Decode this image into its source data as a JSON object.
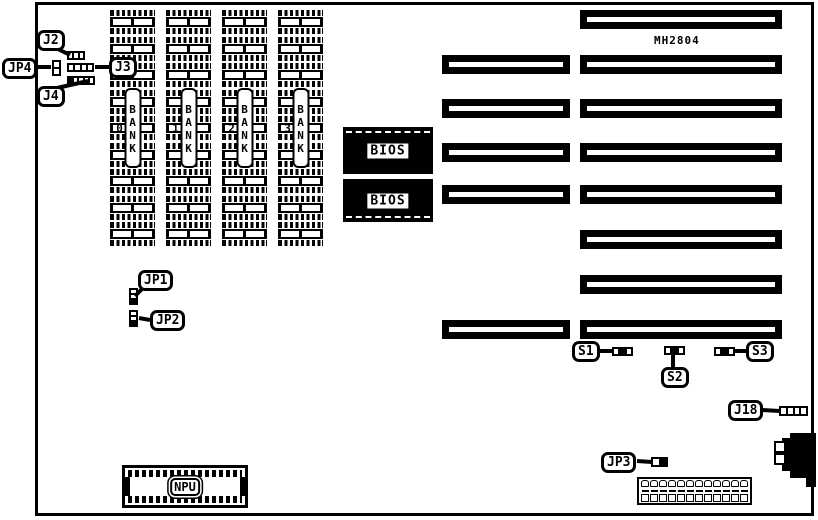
{
  "board": {
    "part_number": "MH2804"
  },
  "labels": {
    "j2": "J2",
    "j3": "J3",
    "j4": "J4",
    "jp1": "JP1",
    "jp2": "JP2",
    "jp3": "JP3",
    "jp4": "JP4",
    "s1": "S1",
    "s2": "S2",
    "s3": "S3",
    "j18": "J18",
    "npu": "NPU",
    "bios": "BIOS"
  },
  "banks": [
    {
      "label": "BANK 0"
    },
    {
      "label": "BANK 1"
    },
    {
      "label": "BANK 2"
    },
    {
      "label": "BANK 3"
    }
  ]
}
